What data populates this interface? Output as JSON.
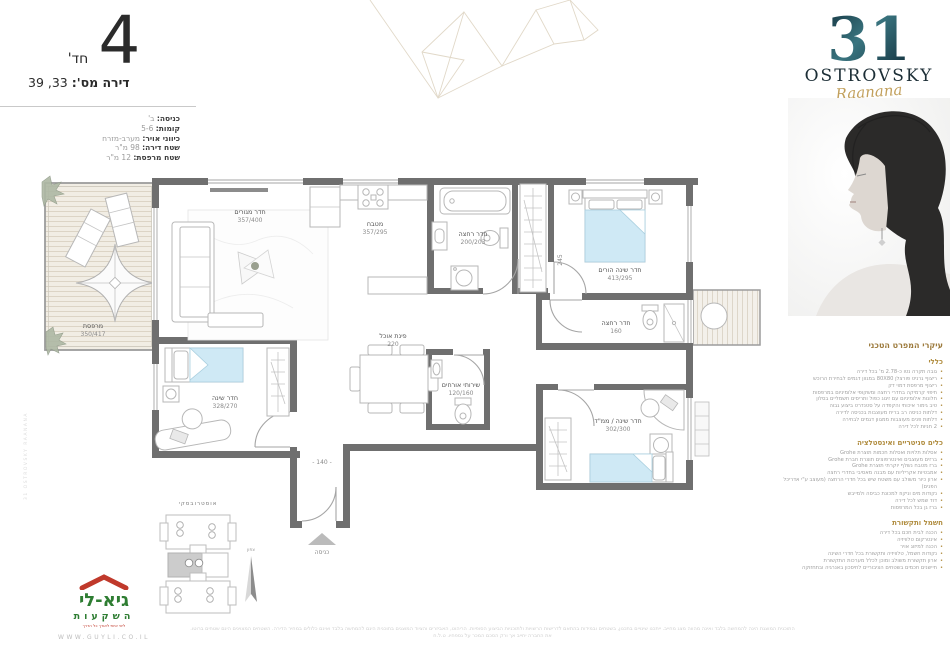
{
  "header": {
    "rooms_number": "4",
    "rooms_suffix": "חד'",
    "apartment_label": "דירה מס':",
    "apartment_numbers": "33, 39",
    "details": [
      {
        "label": "כניסה:",
        "value": "ב'"
      },
      {
        "label": "קומות:",
        "value": "5-6"
      },
      {
        "label": "כיווני אויר:",
        "value": "מערב-מזרח"
      },
      {
        "label": "שטח דירה:",
        "value": "98 מ\"ר"
      },
      {
        "label": "שטח מרפסת:",
        "value": "12 מ\"ר"
      }
    ]
  },
  "brand": {
    "number": "31",
    "name": "OSTROVSKY",
    "script": "Raanana"
  },
  "specs": {
    "title": "עיקרי המפרט הטכני",
    "sections": [
      {
        "heading": "כללי",
        "items": [
          "גובה תקרה נטו כ-2.78 מ' בכל דירה",
          "ריצוף גרניט פורצלן 80X80 במגוון דגמים לבחירת הרוכש",
          "ריצוף מרפסת דמוי דק",
          "חיפוי קרמיקה בחדרי רחצה ומשקופי אלומיניום במרפסות",
          "חלונות אלומיניום עם זיגוג כפול ותריסים חשמליים בסלון",
          "טיב גימור איכותי והקפדה על סטנדרט ביצוע גבוה",
          "דלתות כניסה רב בריח מעוצבות בכניסה לדירה",
          "דלתות פנים מעוצבות ממגוון דגמים לבחירה",
          "2 חניות לכל דירה"
        ]
      },
      {
        "heading": "כלים סניטריים ואינסטלציה",
        "items": [
          "אסלות תלויות ואסלות חכמות תוצרת Grohe",
          "ברזים מעוצבים ואינטרפוצים תוצרת חברת Grohe",
          "ברז מטבח נשלף יוקרתי תוצרת Grohe",
          "אמבטיות אקריליות עם מבנה מאסיבי בחדרי רחצה",
          "ארון כיור משולב עם משטח שיש בכל חדרי הרחצה (מעוצב ע\"י אדריכל הפנים)",
          "נקודות מים וניקוז למכונת כביסה ולמייבש",
          "דוד שמש לכל דירה",
          "ברז גן בכל המרפסות"
        ]
      },
      {
        "heading": "חשמל ותקשורת",
        "items": [
          "הכנה לבית חכם בכל דירה",
          "אינטרקום טלוויזיה",
          "הכנה למיזוג אויר",
          "נקודות חשמל, טלוויזיה ותקשורת בכל חדרי השינה",
          "ארון תקשורת משולב ומוכן לכלל מערכות התקשורת",
          "חיישנים חכמים בשטחים הציבוריים לחיסכון באנרגיה ובתחזוקה"
        ]
      }
    ]
  },
  "plan": {
    "rooms": [
      {
        "name": "חדר מגורים",
        "dims": "357/400"
      },
      {
        "name": "מטבח",
        "dims": "357/295"
      },
      {
        "name": "חדר רחצה",
        "dims": "200/203"
      },
      {
        "name": "חדר שינה הורים",
        "dims": "413/295"
      },
      {
        "name": "חדר רחצה",
        "dims": "160"
      },
      {
        "name": "פינת אוכל",
        "dims": "220"
      },
      {
        "name": "שירותי אורחים",
        "dims": "120/160"
      },
      {
        "name": "חדר שינה",
        "dims": "328/270"
      },
      {
        "name": "חדר שינה / ממ\"ד",
        "dims": "302/300"
      },
      {
        "name": "מרפסת",
        "dims": "350/417"
      }
    ],
    "dims": {
      "entry": "- 140 -",
      "depth": "245"
    },
    "entrance": "כניסה"
  },
  "keyplan": {
    "street": "אוסטרובסקי",
    "north": "צפון"
  },
  "developer": {
    "name": "גיא-לי",
    "sub": "השקעות",
    "tagline": "ליווי אישי לאורך כל הדרך",
    "website": "WWW.GUYLI.CO.IL"
  },
  "disclaimer": {
    "line1": "התוכנית המוצגת הינה להמחשה בלבד ואינה מהווה מצג מחייב. ייתכנו שינויים בתכנון, בשטחים ובמידות בהתאם לדרישות הרשויות ולתוכניות הביצוע הסופיות. הריהוט, האביזרים והציוד המוצגים בתוכנית הינם להמחשה בלבד ואינם כלולים במחיר הדירה. השטחים המצוינים הינם שטחים ברוטו.",
    "line2": "את החברה יחייב אך ורק הסכם המכר על נספחיו. ט.ל.ח"
  },
  "side_mark": "31 OSTROVSKY RAANANA"
}
